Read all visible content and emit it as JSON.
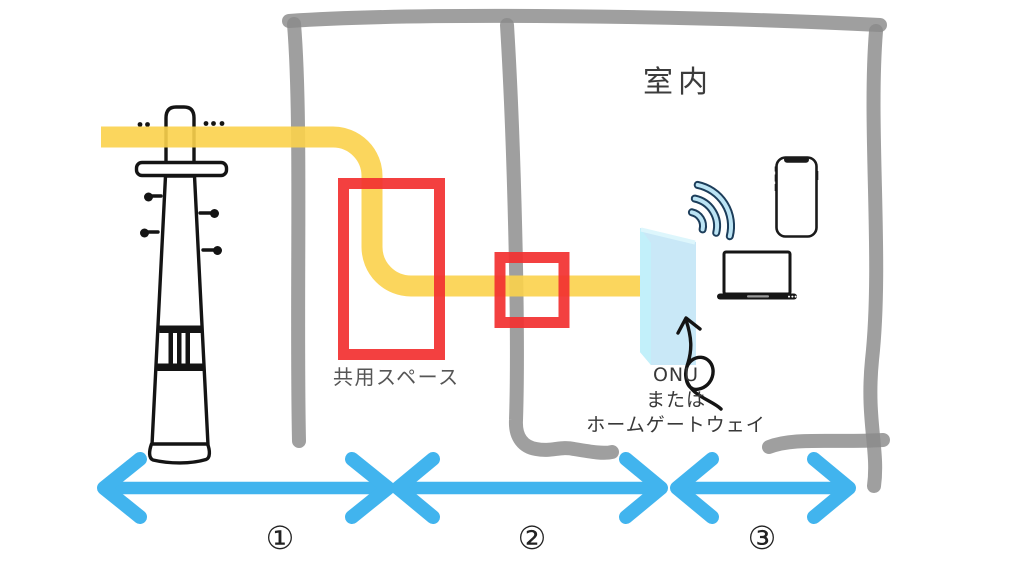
{
  "diagram": {
    "title_context": "fiber-internet-installation-diagram",
    "room_label": "室内",
    "shared_space_label": "共用スペース",
    "onu_label": {
      "line1": "ONU",
      "line2": "または",
      "line3": "ホームゲートウェイ"
    },
    "sections": [
      {
        "symbol": "①"
      },
      {
        "symbol": "②"
      },
      {
        "symbol": "③"
      }
    ]
  },
  "colors": {
    "wall_gray": "#8A8A8A",
    "cable_yellow": "#FBD24B",
    "highlight_red": "#F23030",
    "arrow_blue": "#41B4EE",
    "onu_front": "#C9E8F7",
    "onu_side": "#C2F0FA",
    "onu_top": "#DDF6FC",
    "wifi_outline": "#1C3D5A",
    "wifi_fill": "#BCE4F4",
    "ink_black": "#141414",
    "text_dark": "#3C3C3C",
    "text_gray": "#565656"
  }
}
